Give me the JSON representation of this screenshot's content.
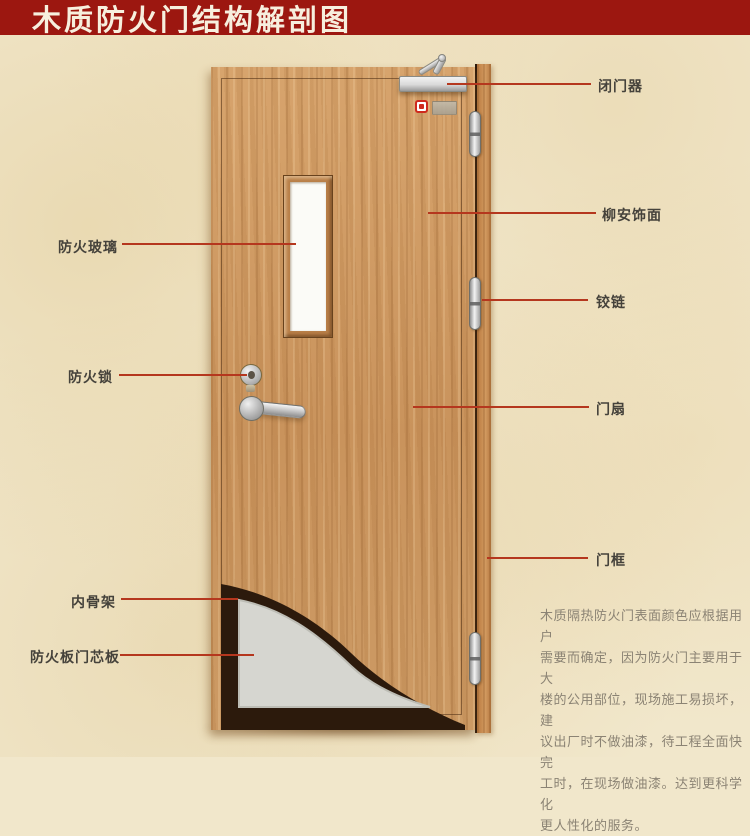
{
  "title": {
    "text": "木质防火门结构解剖图"
  },
  "labels": {
    "right": [
      {
        "id": "door-closer",
        "text": "闭门器"
      },
      {
        "id": "lauan-veneer",
        "text": "柳安饰面"
      },
      {
        "id": "hinge",
        "text": "铰链"
      },
      {
        "id": "door-leaf",
        "text": "门扇"
      },
      {
        "id": "door-frame",
        "text": "门框"
      }
    ],
    "left": [
      {
        "id": "fire-glass",
        "text": "防火玻璃"
      },
      {
        "id": "fire-lock",
        "text": "防火锁"
      },
      {
        "id": "inner-skeleton",
        "text": "内骨架"
      },
      {
        "id": "fire-board-core",
        "text": "防火板门芯板"
      }
    ]
  },
  "note": {
    "lines": [
      "木质隔热防火门表面颜色应根据用户",
      "需要而确定，因为防火门主要用于大",
      "楼的公用部位，现场施工易损坏，建",
      "议出厂时不做油漆，待工程全面快完",
      "工时，在现场做油漆。达到更科学化",
      "更人性化的服务。"
    ]
  },
  "colors": {
    "title_bar": "#9c1710",
    "title_text": "#f7efde",
    "background": "#f1e7cb",
    "pointer_line": "#b5371e",
    "wood": "#cf9a63",
    "core_board": "#d6d6d0",
    "inner_skeleton": "#2c1a0c"
  }
}
